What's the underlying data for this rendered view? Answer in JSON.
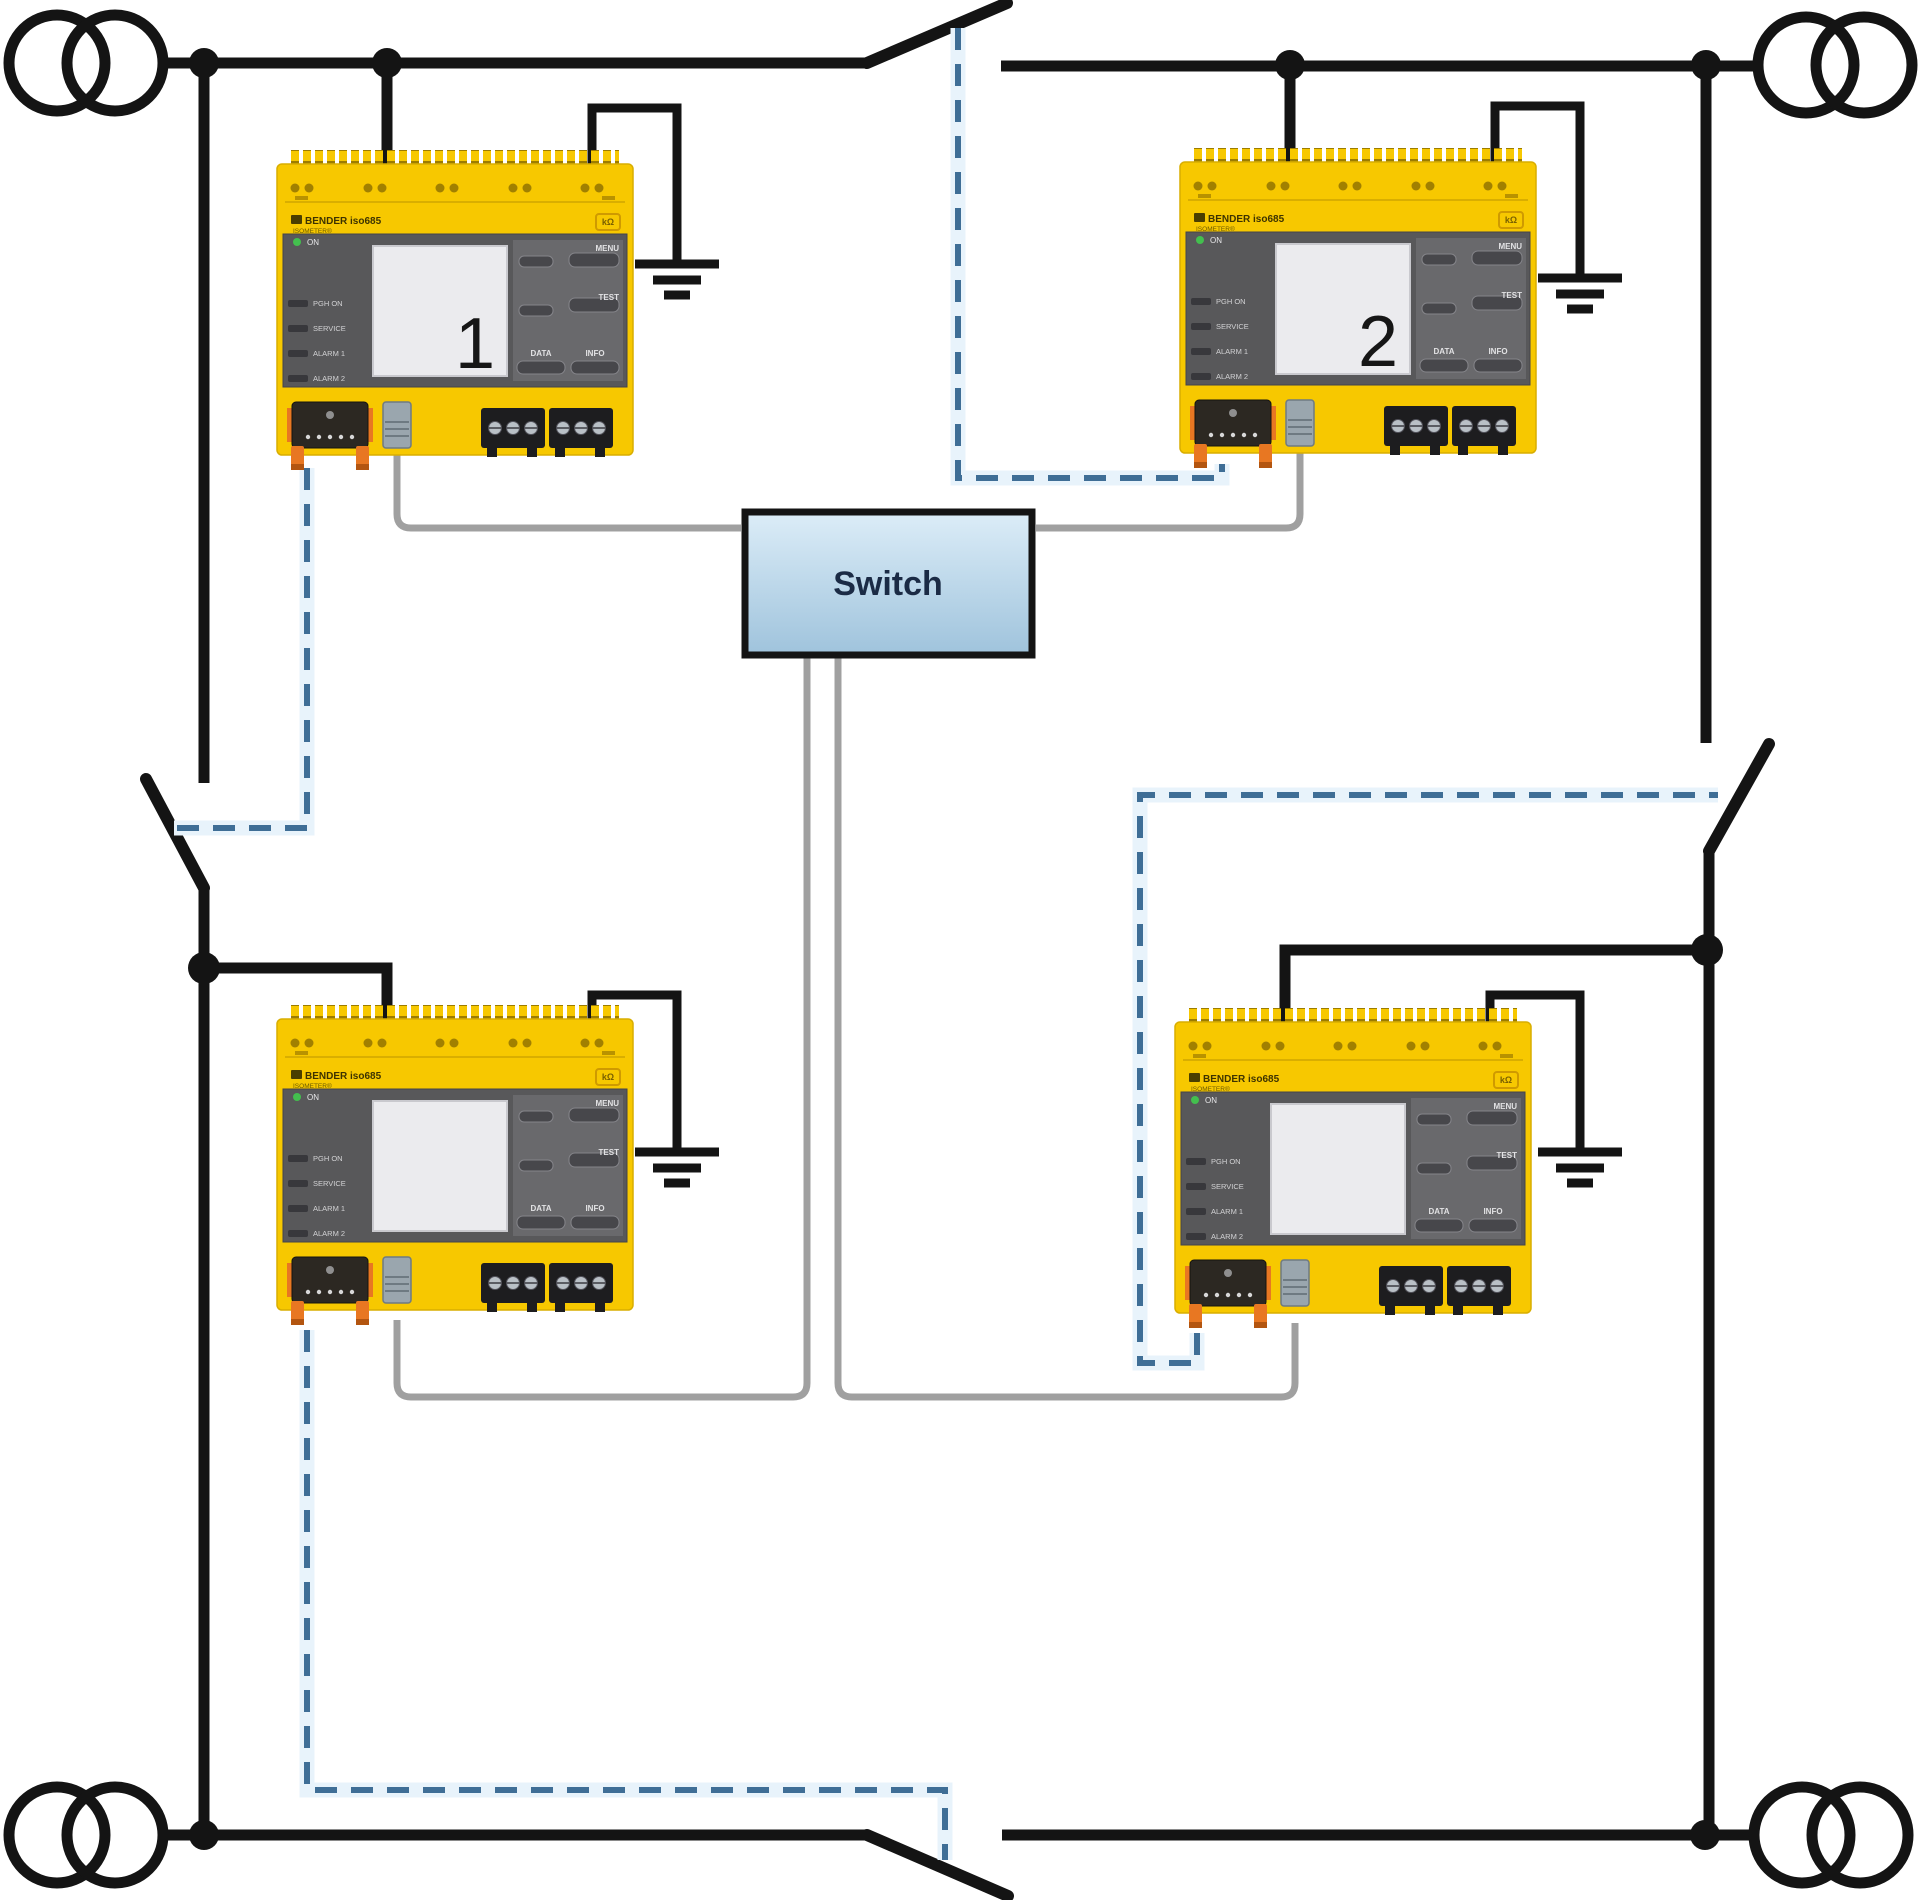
{
  "diagram": {
    "switch": {
      "label": "Switch"
    },
    "device_labels": {
      "brand": "BENDER iso685",
      "sub_brand": "ISOMETER®",
      "unit_badge": "kΩ",
      "leds": [
        "ON",
        "PGH ON",
        "SERVICE",
        "ALARM 1",
        "ALARM 2"
      ],
      "buttons": [
        "MENU",
        "TEST",
        "DATA",
        "INFO"
      ]
    },
    "devices": [
      {
        "name": "iso685-device-1",
        "display_number": "1"
      },
      {
        "name": "iso685-device-2",
        "display_number": "2"
      },
      {
        "name": "iso685-device-3",
        "display_number": ""
      },
      {
        "name": "iso685-device-4",
        "display_number": ""
      }
    ],
    "colors": {
      "device_yellow": "#f7c800",
      "panel_gray": "#58585a",
      "switch_fill_top": "#dcedf8",
      "switch_fill_bottom": "#9fc3dc",
      "line_black": "#141414",
      "cable_gray": "#a0a0a0",
      "control_dashed_blue": "#3f6e96",
      "connector_orange": "#e87722"
    }
  }
}
